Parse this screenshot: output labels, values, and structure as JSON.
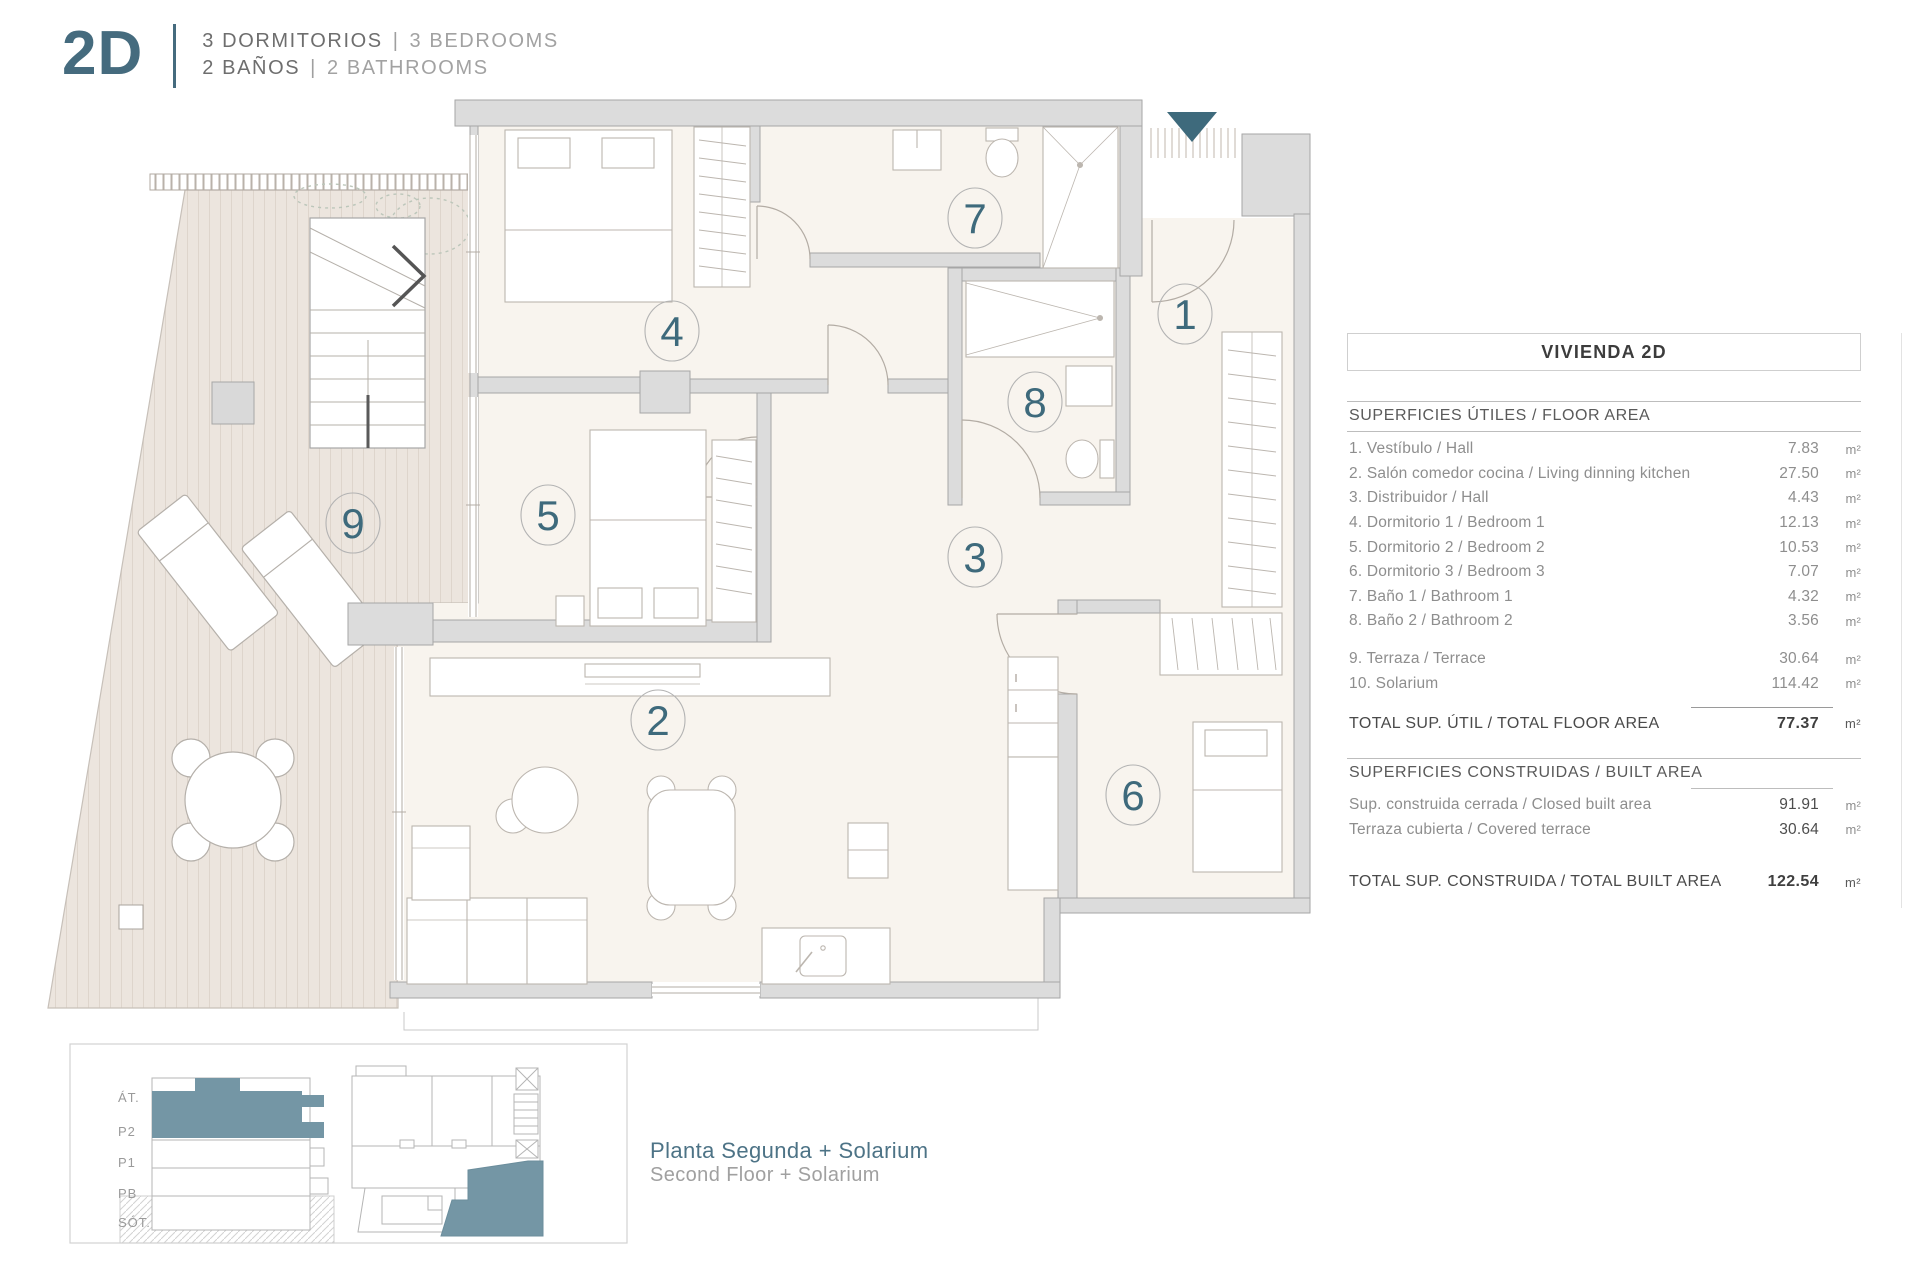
{
  "header": {
    "unit": "2D",
    "rooms_es": "3 DORMITORIOS",
    "rooms_en": "3 BEDROOMS",
    "baths_es": "2 BAÑOS",
    "baths_en": "2 BATHROOMS",
    "separator": "|"
  },
  "panel": {
    "title": "VIVIENDA 2D",
    "unit_suffix": "m²",
    "floor_area": {
      "heading": "SUPERFICIES ÚTILES / FLOOR AREA",
      "rows": [
        {
          "label": "1. Vestíbulo / Hall",
          "value": "7.83"
        },
        {
          "label": "2. Salón comedor cocina / Living dinning kitchen",
          "value": "27.50"
        },
        {
          "label": "3. Distribuidor / Hall",
          "value": "4.43"
        },
        {
          "label": "4. Dormitorio 1 / Bedroom 1",
          "value": "12.13"
        },
        {
          "label": "5. Dormitorio 2 / Bedroom 2",
          "value": "10.53"
        },
        {
          "label": "6. Dormitorio 3 / Bedroom 3",
          "value": "7.07"
        },
        {
          "label": "7. Baño 1 / Bathroom 1",
          "value": "4.32"
        },
        {
          "label": "8. Baño 2 / Bathroom 2",
          "value": "3.56"
        }
      ],
      "extra_rows": [
        {
          "label": "9. Terraza / Terrace",
          "value": "30.64"
        },
        {
          "label": "10. Solarium",
          "value": "114.42"
        }
      ],
      "total_label": "TOTAL SUP. ÚTIL / TOTAL FLOOR AREA",
      "total_value": "77.37"
    },
    "built_area": {
      "heading": "SUPERFICIES CONSTRUIDAS / BUILT AREA",
      "rows": [
        {
          "label": "Sup. construida cerrada / Closed built area",
          "value": "91.91"
        },
        {
          "label": "Terraza cubierta / Covered terrace",
          "value": "30.64"
        }
      ],
      "total_label": "TOTAL SUP. CONSTRUIDA /  TOTAL BUILT AREA",
      "total_value": "122.54"
    }
  },
  "plan": {
    "room_numbers": [
      {
        "n": "1",
        "x": 1185,
        "y": 314
      },
      {
        "n": "2",
        "x": 658,
        "y": 720
      },
      {
        "n": "3",
        "x": 975,
        "y": 557
      },
      {
        "n": "4",
        "x": 672,
        "y": 331
      },
      {
        "n": "5",
        "x": 548,
        "y": 515
      },
      {
        "n": "6",
        "x": 1133,
        "y": 795
      },
      {
        "n": "7",
        "x": 975,
        "y": 218
      },
      {
        "n": "8",
        "x": 1035,
        "y": 402
      },
      {
        "n": "9",
        "x": 353,
        "y": 523
      }
    ]
  },
  "mini": {
    "levels": [
      "ÁT.",
      "P2",
      "P1",
      "PB",
      "SÓT."
    ],
    "caption_es": "Planta Segunda + Solarium",
    "caption_en": "Second Floor + Solarium"
  },
  "colors": {
    "teal_dark": "#3e6a7c",
    "teal_mid": "#7496a5",
    "wall": "#dcdcdc",
    "wall_stroke": "#a6a6a6",
    "floor": "#f8f4ee",
    "terrace": "#ece5de"
  }
}
